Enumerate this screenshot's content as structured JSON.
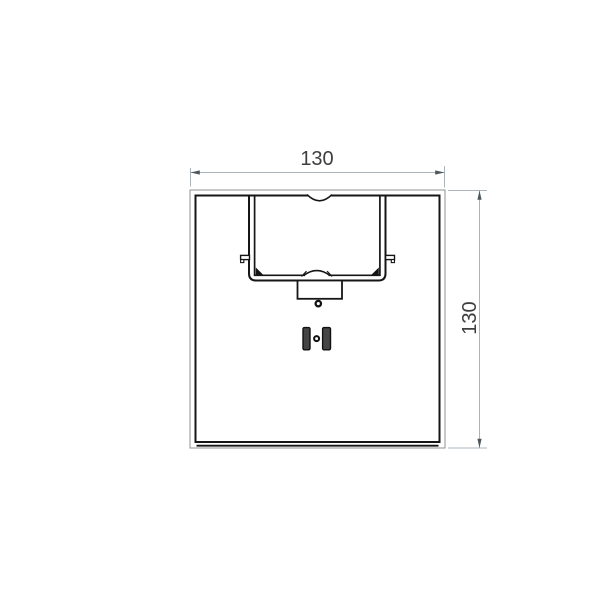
{
  "drawing": {
    "type": "technical-section-drawing",
    "part_name": "square-profile-cross-section",
    "dimensions": {
      "width": {
        "label": "130"
      },
      "height": {
        "label": "130"
      }
    },
    "colors": {
      "background": "#ffffff",
      "edge_thick": "#161616",
      "edge_thin": "#909090",
      "dimension_line": "#a9b4bb",
      "dimension_arrow": "#4d575d",
      "dimension_text": "#3e3e3e",
      "slot_fill": "#454545"
    }
  }
}
